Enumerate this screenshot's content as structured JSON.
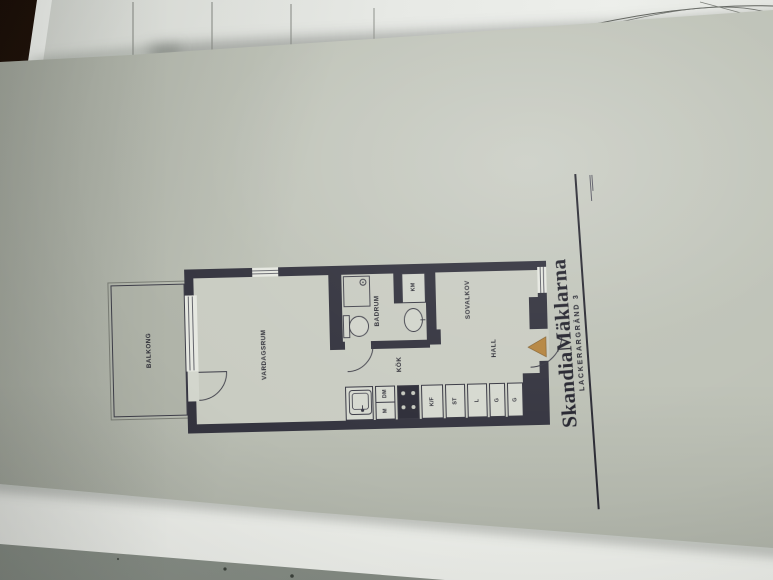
{
  "floor_plan": {
    "rooms": {
      "balkong": "BALKONG",
      "vardagsrum": "VARDAGSRUM",
      "badrum": "BADRUM",
      "kok": "KÖK",
      "sovalkov": "SOVALKOV",
      "hall": "HALL"
    },
    "closets_appliances": {
      "km": "KM",
      "dm": "DM",
      "m": "M",
      "kf": "K/F",
      "st": "ST",
      "l": "L",
      "g1": "G",
      "g2": "G"
    },
    "colors": {
      "wall": "#34343f",
      "paper": "#bec2b7",
      "interior_fill": "#c9ccc2",
      "balcony_fill": "#b0b4a9",
      "entry_arrow": "#b5843f"
    }
  },
  "footer": {
    "brand": "SkandiaMäklarna",
    "address": "LACKERARGRÄND 3"
  }
}
